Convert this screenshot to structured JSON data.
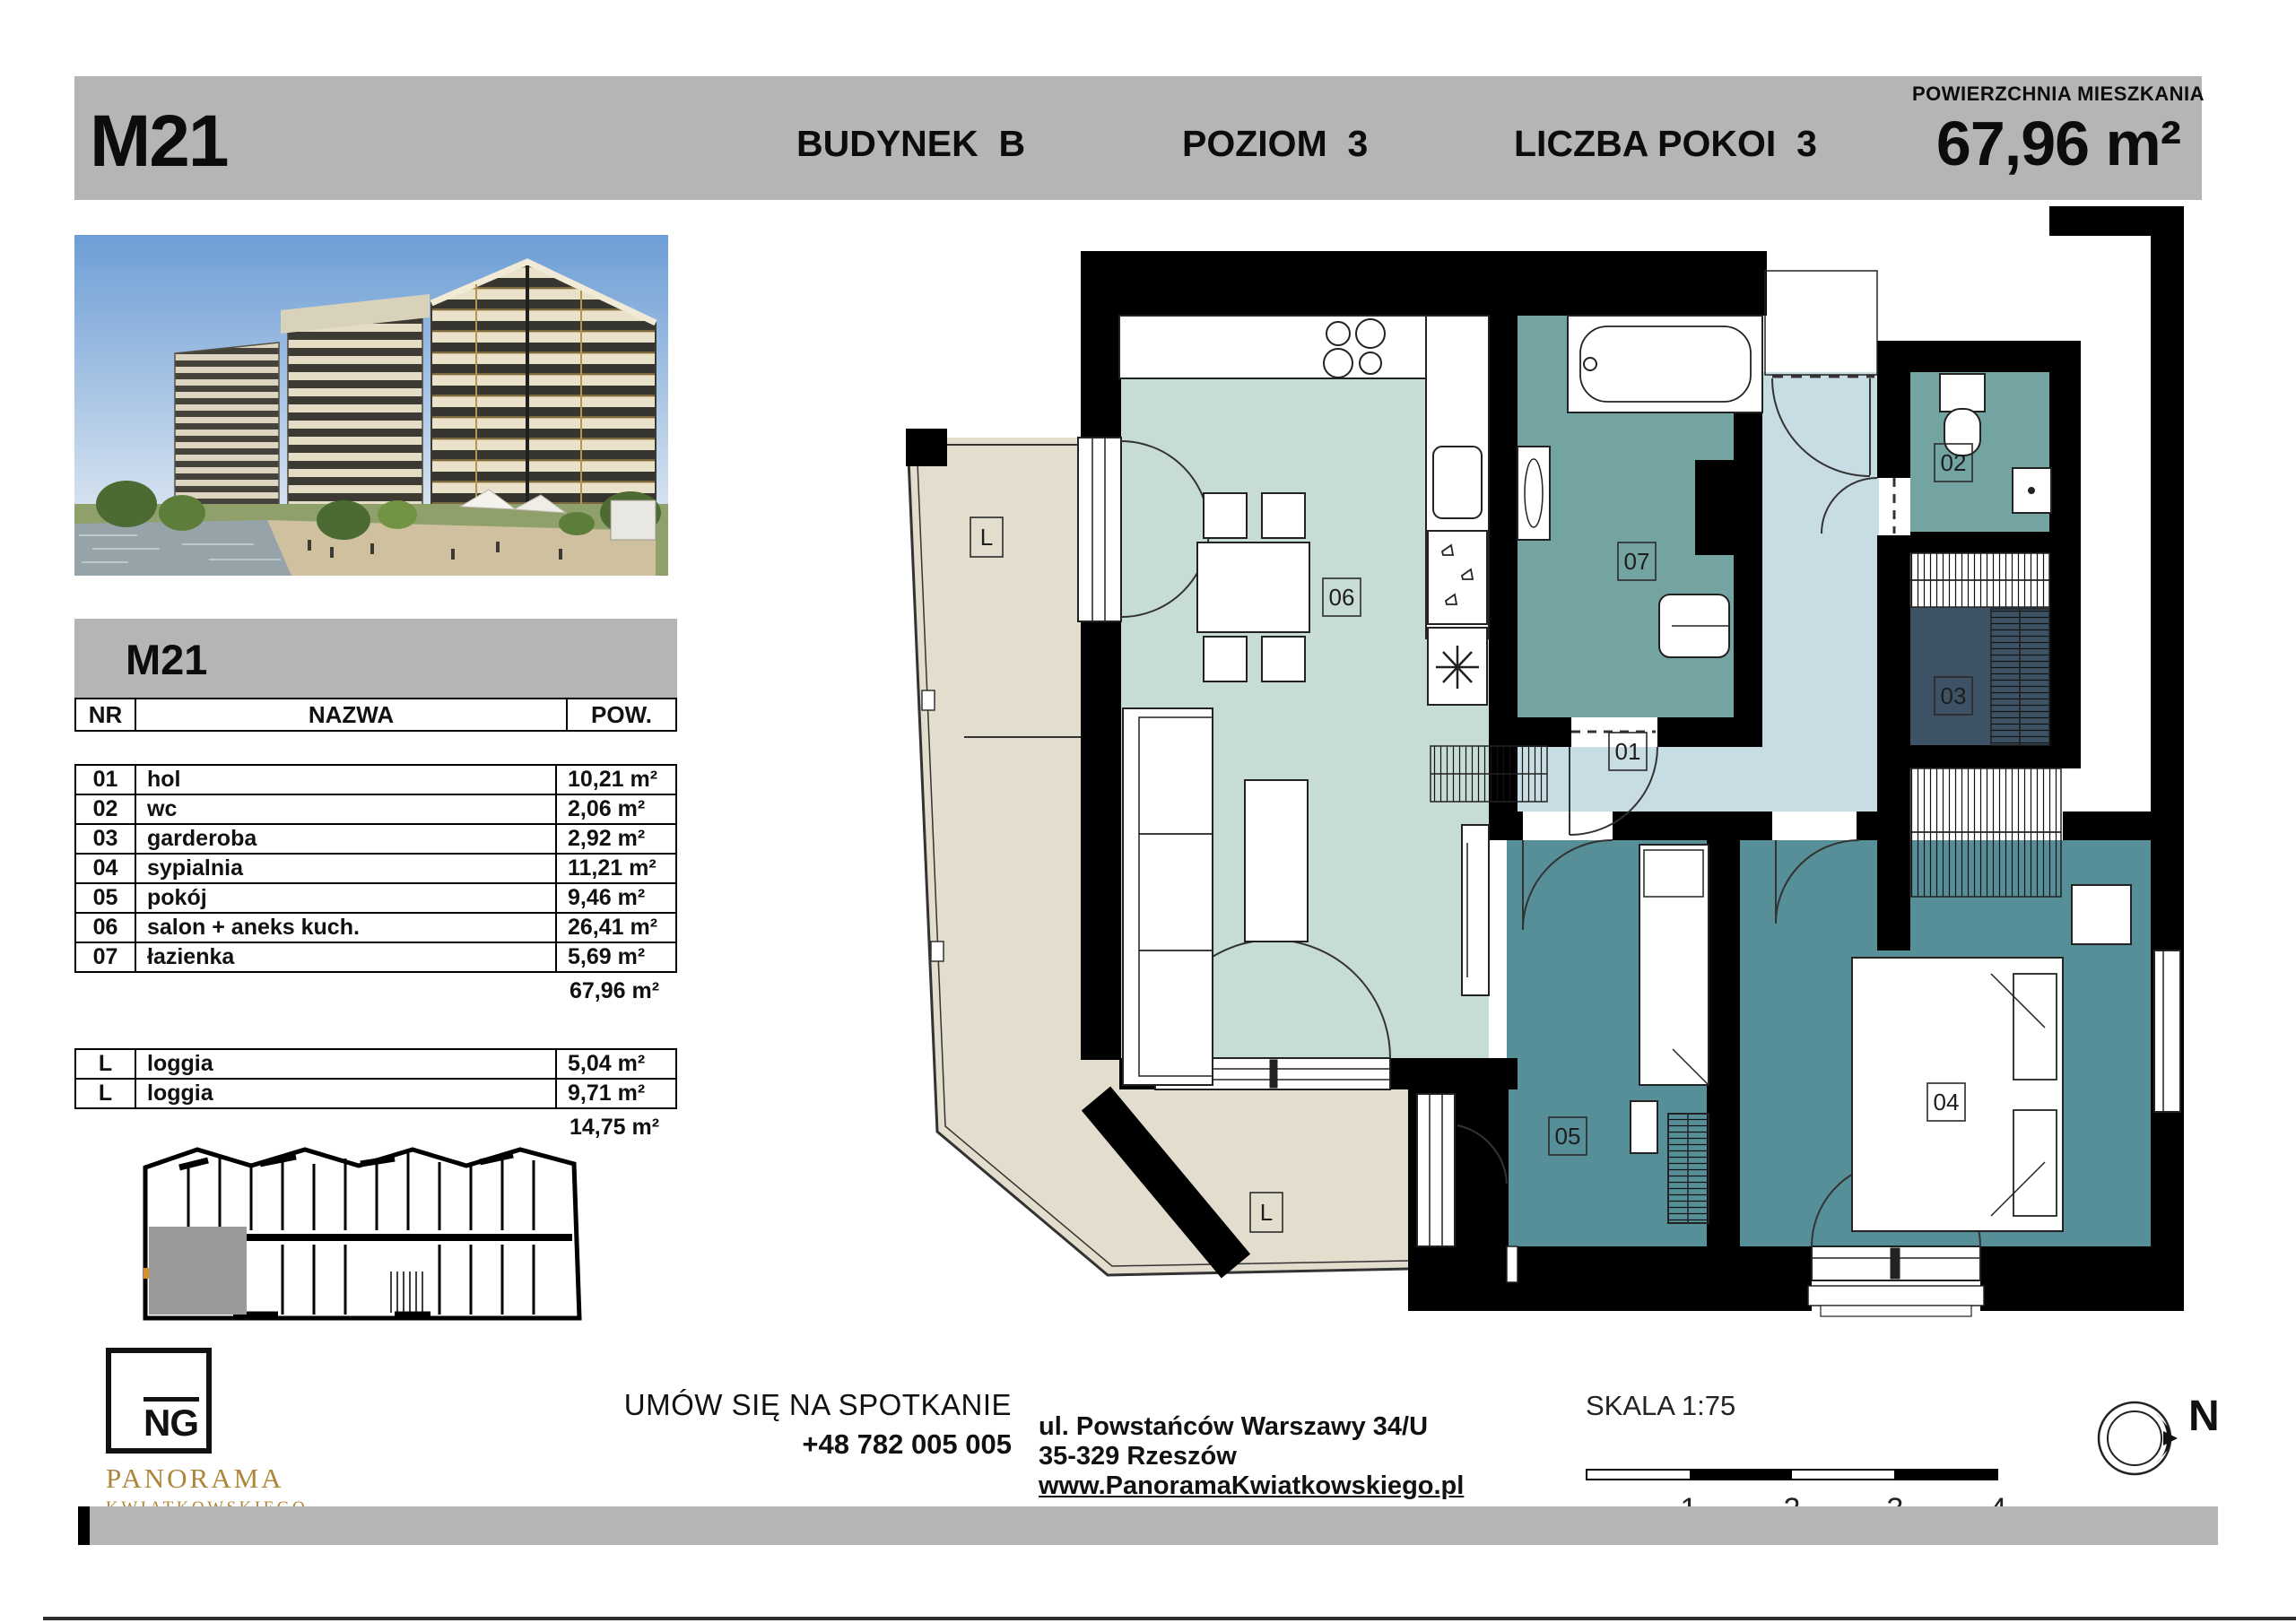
{
  "header": {
    "unit": "M21",
    "building": "BUDYNEK  B",
    "level": "POZIOM  3",
    "rooms": "LICZBA POKOI  3",
    "area_label": "POWIERZCHNIA MIESZKANIA",
    "area_value": "67,96 m²"
  },
  "table": {
    "title": "M21",
    "columns": [
      "NR",
      "NAZWA",
      "POW."
    ],
    "rows": [
      {
        "nr": "01",
        "name": "hol",
        "area": "10,21 m²"
      },
      {
        "nr": "02",
        "name": "wc",
        "area": "2,06 m²"
      },
      {
        "nr": "03",
        "name": "garderoba",
        "area": "2,92 m²"
      },
      {
        "nr": "04",
        "name": "sypialnia",
        "area": "11,21 m²"
      },
      {
        "nr": "05",
        "name": "pokój",
        "area": "9,46 m²"
      },
      {
        "nr": "06",
        "name": "salon + aneks kuch.",
        "area": "26,41 m²"
      },
      {
        "nr": "07",
        "name": "łazienka",
        "area": "5,69 m²"
      }
    ],
    "total": "67,96 m²",
    "loggia_rows": [
      {
        "nr": "L",
        "name": "loggia",
        "area": "5,04 m²"
      },
      {
        "nr": "L",
        "name": "loggia",
        "area": "9,71 m²"
      }
    ],
    "loggia_total": "14,75 m²"
  },
  "plan": {
    "labels": {
      "r01": "01",
      "r02": "02",
      "r03": "03",
      "r04": "04",
      "r05": "05",
      "r06": "06",
      "r07": "07",
      "loggia": "L"
    }
  },
  "contact": {
    "cta": "UMÓW SIĘ NA SPOTKANIE",
    "phone": "+48 782 005 005",
    "address_line1": "ul. Powstańców Warszawy 34/U",
    "address_line2": "35-329 Rzeszów",
    "website": "www.PanoramaKwiatkowskiego.pl"
  },
  "scale": {
    "label": "SKALA 1:75",
    "ticks": [
      "1",
      "2",
      "3",
      "4"
    ]
  },
  "compass": {
    "label": "N"
  },
  "logo": {
    "monogram": "NG",
    "line1": "PANORAMA",
    "line2": "KWIATKOWSKIEGO"
  },
  "colors": {
    "header_bar": "#b5b5b5",
    "salon": "#c8dcd7",
    "hall": "#c7dde3",
    "bath": "#73a4a2",
    "room": "#578f98",
    "wardrobe_room": "#3d5365",
    "loggia": "#e3ddcd",
    "highlight_unit": "#9a9a9a",
    "accent_gold": "#ad8639"
  }
}
